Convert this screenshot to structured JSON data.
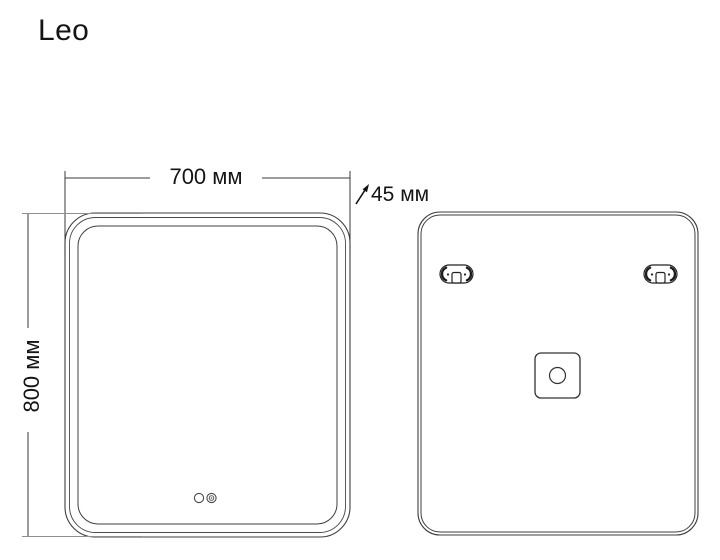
{
  "title": "Leo",
  "dimensions": {
    "width_label": "700 мм",
    "depth_label": "45 мм",
    "height_label": "800 мм"
  },
  "icons": {
    "depth_arrow": "diagonal-arrow-icon",
    "touch_button": "touch-button-icon",
    "power_indicator": "indicator-icon",
    "mounting_bracket": "mounting-bracket-icon",
    "junction_box": "junction-box-icon"
  },
  "colors": {
    "background": "#ffffff",
    "drawing_line": "#3f3f3f",
    "extension_line": "#8f8f8f",
    "text": "#141414"
  }
}
